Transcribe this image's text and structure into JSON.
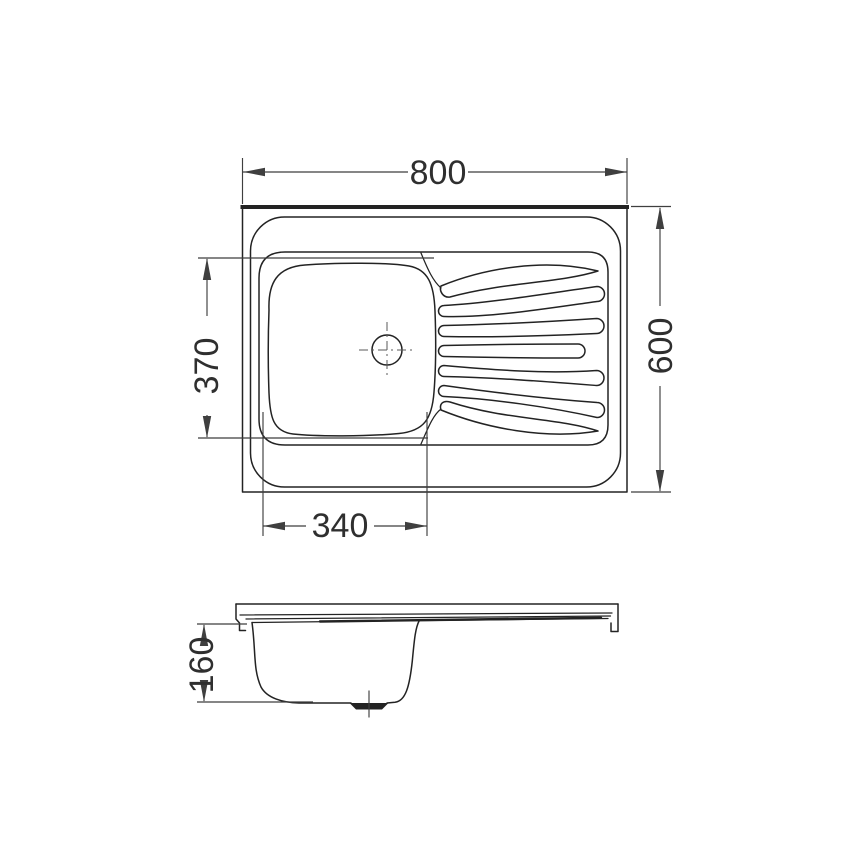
{
  "dims": {
    "overall_width": "800",
    "overall_depth": "600",
    "bowl_length": "370",
    "bowl_width": "340",
    "bowl_depth": "160"
  },
  "colors": {
    "line": "#232323",
    "dim": "#3f3f3f",
    "text": "#2f2f2f",
    "bg": "#ffffff"
  }
}
